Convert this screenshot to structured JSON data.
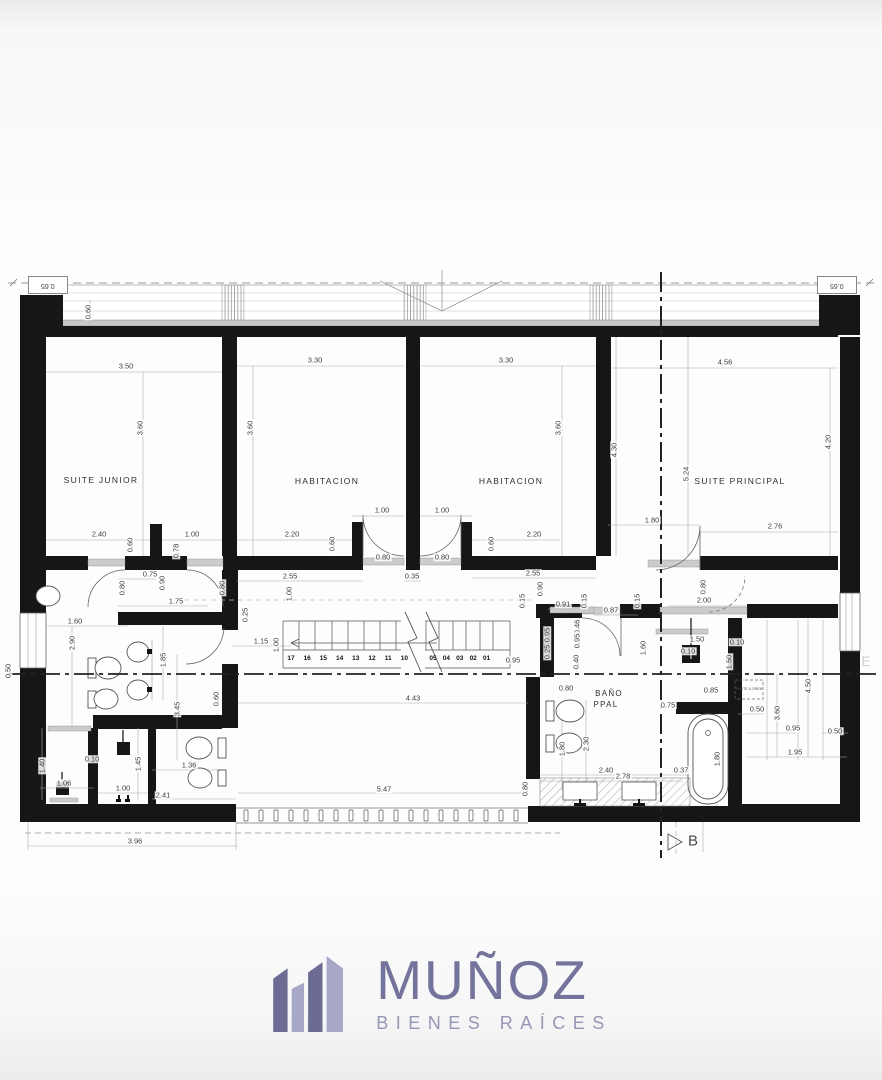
{
  "plan": {
    "corner_dims": [
      "0.65",
      "0.65"
    ],
    "rooms": [
      {
        "label": "SUITE JUNIOR",
        "x": 101,
        "y": 480
      },
      {
        "label": "HABITACION",
        "x": 327,
        "y": 481
      },
      {
        "label": "HABITACION",
        "x": 511,
        "y": 481
      },
      {
        "label": "SUITE PRINCIPAL",
        "x": 740,
        "y": 481
      },
      {
        "label": "BAÑO",
        "x": 609,
        "y": 694,
        "fs": 8
      },
      {
        "label": "PPAL",
        "x": 606,
        "y": 705,
        "fs": 8
      }
    ],
    "dims": [
      [
        "0.60",
        88,
        312,
        1
      ],
      [
        "3.50",
        126,
        366,
        0
      ],
      [
        "3.60",
        140,
        428,
        1
      ],
      [
        "3.30",
        315,
        360,
        0
      ],
      [
        "3.60",
        250,
        428,
        1
      ],
      [
        "3.30",
        506,
        360,
        0
      ],
      [
        "3.60",
        558,
        428,
        1
      ],
      [
        "4.56",
        725,
        362,
        0
      ],
      [
        "4.20",
        828,
        442,
        1
      ],
      [
        "5.24",
        686,
        474,
        1
      ],
      [
        "4.30",
        614,
        450,
        1
      ],
      [
        "1.80",
        652,
        520,
        0
      ],
      [
        "2.76",
        775,
        526,
        0
      ],
      [
        "2.40",
        99,
        534,
        0
      ],
      [
        "0.60",
        130,
        545,
        1
      ],
      [
        "1.00",
        192,
        534,
        0
      ],
      [
        "0.78",
        176,
        551,
        1
      ],
      [
        "2.20",
        292,
        534,
        0
      ],
      [
        "0.60",
        332,
        544,
        1
      ],
      [
        "1.00",
        382,
        510,
        0
      ],
      [
        "1.00",
        442,
        510,
        0
      ],
      [
        "0.80",
        383,
        557,
        0
      ],
      [
        "0.80",
        442,
        557,
        0
      ],
      [
        "0.60",
        491,
        544,
        1
      ],
      [
        "2.20",
        534,
        534,
        0
      ],
      [
        "0.90",
        540,
        589,
        1
      ],
      [
        "2.55",
        290,
        576,
        0
      ],
      [
        "0.35",
        412,
        576,
        0
      ],
      [
        "2.55",
        533,
        573,
        0
      ],
      [
        "0.75",
        150,
        574,
        0
      ],
      [
        "0.80",
        122,
        588,
        1
      ],
      [
        "0.90",
        162,
        583,
        1
      ],
      [
        "1.75",
        176,
        601,
        0
      ],
      [
        "0.80",
        222,
        588,
        1
      ],
      [
        "0.15",
        522,
        601,
        1
      ],
      [
        "0.91",
        563,
        604,
        0
      ],
      [
        "0.15",
        584,
        601,
        1
      ],
      [
        "0.87",
        611,
        610,
        0
      ],
      [
        "0.15",
        637,
        601,
        1
      ],
      [
        "2.00",
        704,
        600,
        0
      ],
      [
        "0.80",
        703,
        587,
        1
      ],
      [
        "0.25",
        245,
        615,
        1
      ],
      [
        "1.00",
        289,
        594,
        1
      ],
      [
        "1.15",
        261,
        641,
        0
      ],
      [
        "1.00",
        276,
        645,
        1
      ],
      [
        "0.95",
        513,
        660,
        0
      ],
      [
        "0.95",
        547,
        635,
        1
      ],
      [
        "0.25",
        547,
        652,
        1
      ],
      [
        "0.46",
        577,
        627,
        1
      ],
      [
        "0.95",
        577,
        641,
        1
      ],
      [
        "0.40",
        576,
        662,
        1
      ],
      [
        "0.80",
        566,
        688,
        0
      ],
      [
        "1.60",
        75,
        621,
        0
      ],
      [
        "2.90",
        72,
        643,
        1
      ],
      [
        "1.85",
        163,
        660,
        1
      ],
      [
        "3.45",
        177,
        709,
        1
      ],
      [
        "0.60",
        216,
        699,
        1
      ],
      [
        "0.50",
        8,
        671,
        1
      ],
      [
        "1.40",
        42,
        766,
        1
      ],
      [
        "1.06",
        64,
        783,
        0
      ],
      [
        "0.10",
        92,
        759,
        0
      ],
      [
        "1.45",
        138,
        764,
        1
      ],
      [
        "1.00",
        123,
        788,
        0
      ],
      [
        "2.41",
        163,
        795,
        0
      ],
      [
        "1.36",
        189,
        765,
        0
      ],
      [
        "3.96",
        135,
        841,
        0
      ],
      [
        "4.43",
        413,
        698,
        0
      ],
      [
        "5.47",
        384,
        789,
        0
      ],
      [
        "0.80",
        525,
        789,
        1
      ],
      [
        "0.75",
        668,
        705,
        0
      ],
      [
        "2.30",
        586,
        744,
        1
      ],
      [
        "1.80",
        562,
        749,
        1
      ],
      [
        "2.40",
        606,
        770,
        0
      ],
      [
        "2.78",
        623,
        776,
        0
      ],
      [
        "0.37",
        681,
        770,
        0
      ],
      [
        "1.80",
        717,
        759,
        1
      ],
      [
        "1.50",
        697,
        639,
        0
      ],
      [
        "0.10",
        688,
        651,
        0
      ],
      [
        "0.10",
        737,
        642,
        0
      ],
      [
        "1.50",
        729,
        662,
        1
      ],
      [
        "0.85",
        711,
        690,
        0
      ],
      [
        "1.60",
        643,
        648,
        1
      ],
      [
        "0.50",
        757,
        709,
        0
      ],
      [
        "3.60",
        777,
        713,
        1
      ],
      [
        "4.50",
        808,
        686,
        1
      ],
      [
        "0.95",
        793,
        728,
        0
      ],
      [
        "0.50",
        835,
        731,
        0
      ],
      [
        "1.95",
        795,
        752,
        0
      ]
    ],
    "stairs": {
      "flights": [
        {
          "x": 291,
          "step": 16.2,
          "y": 659,
          "nums": [
            "17",
            "16",
            "15",
            "14",
            "13",
            "12",
            "11",
            "10"
          ]
        },
        {
          "x": 433,
          "step": 13.4,
          "y": 659,
          "nums": [
            "05",
            "04",
            "03",
            "02",
            "01"
          ]
        }
      ]
    },
    "markers": [
      {
        "t": "B",
        "x": 693,
        "y": 841,
        "fs": 15,
        "c": "#4a4a4a"
      },
      {
        "t": "E",
        "x": 866,
        "y": 661,
        "fs": 14,
        "c": "#cfcfcf"
      },
      {
        "t": "SHUTE & DREN",
        "x": 749,
        "y": 690,
        "fs": 3.6,
        "c": "#555555"
      }
    ]
  },
  "logo": {
    "name": "MUÑOZ",
    "tagline": "BIENES RAÍCES",
    "color_dark": "#6b6b93",
    "color_light": "#a7a7c8",
    "name_color": "#73739c",
    "tagline_color": "#9696b5"
  }
}
